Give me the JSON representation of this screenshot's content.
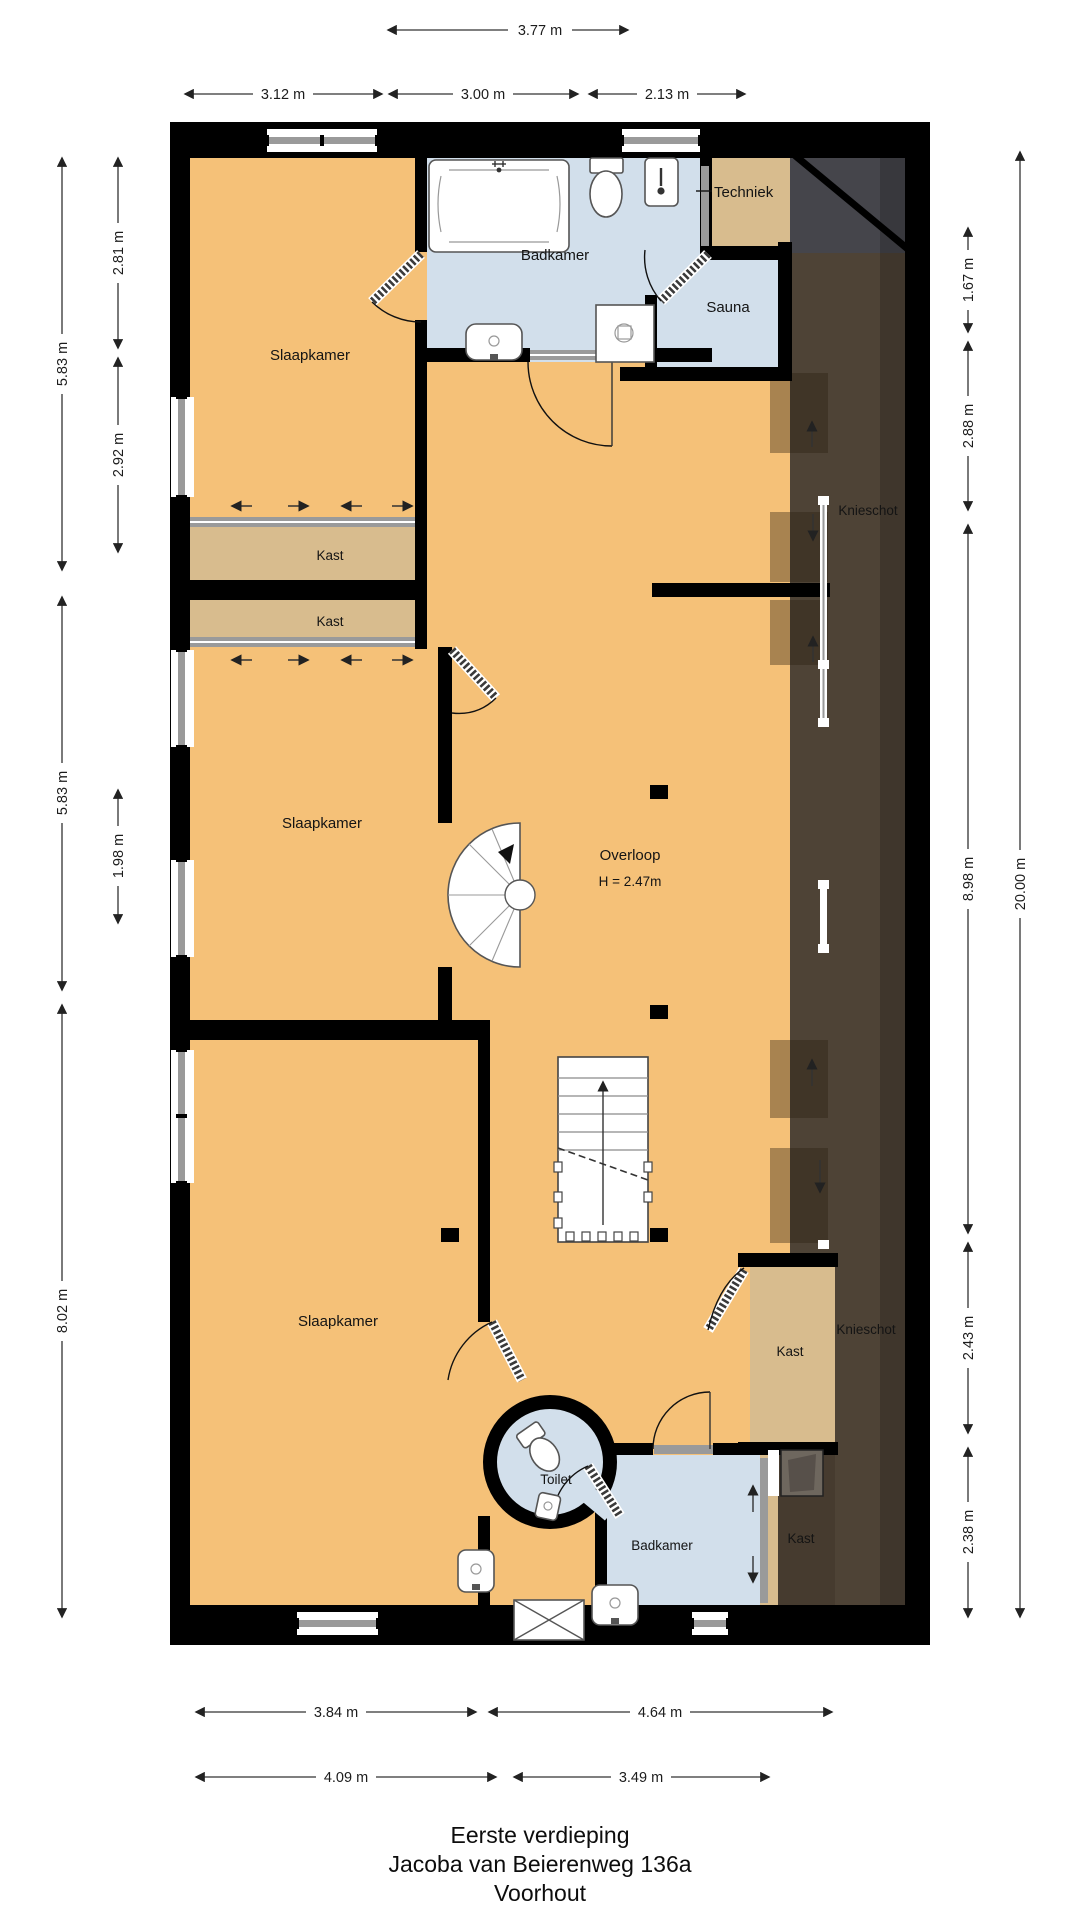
{
  "title": {
    "line1": "Eerste verdieping",
    "line2": "Jacoba van Beierenweg 136a",
    "line3": "Voorhout"
  },
  "rooms": {
    "slaapkamer_top": "Slaapkamer",
    "badkamer_top": "Badkamer",
    "techniek": "Techniek",
    "sauna": "Sauna",
    "knieschot_top": "Knieschot",
    "kast_upper": "Kast",
    "kast_lower": "Kast",
    "slaapkamer_mid": "Slaapkamer",
    "overloop": "Overloop",
    "overloop_height": "H = 2.47m",
    "slaapkamer_bottom": "Slaapkamer",
    "kast_bottom_right": "Kast",
    "knieschot_bottom": "Knieschot",
    "toilet": "Toilet",
    "badkamer_bottom": "Badkamer",
    "kast_badkamer": "Kast"
  },
  "dimensions": {
    "top": {
      "overall": "3.77 m",
      "left": "3.12 m",
      "middle": "3.00 m",
      "right": "2.13 m"
    },
    "left": {
      "outer_top": "5.83 m",
      "outer_mid": "5.83 m",
      "outer_bottom": "8.02 m",
      "inner_top": "2.81 m",
      "inner_mid": "2.92 m",
      "inner_low": "1.98 m"
    },
    "right": {
      "overall": "20.00 m",
      "seg1": "1.67 m",
      "seg2": "2.88 m",
      "seg3": "8.98 m",
      "seg4": "2.43 m",
      "seg5": "2.38 m"
    },
    "bottom": {
      "row1_left": "3.84 m",
      "row1_right": "4.64 m",
      "row2_left": "4.09 m",
      "row2_right": "3.49 m"
    }
  },
  "colors": {
    "floor": "#F5C178",
    "closet": "#D8BC8E",
    "wet": "#D2DFEB",
    "attic": "#4E4336",
    "attic_gray": "#45454B",
    "wall": "#000000",
    "window": "#9A9A9A",
    "dim": "#333333"
  }
}
